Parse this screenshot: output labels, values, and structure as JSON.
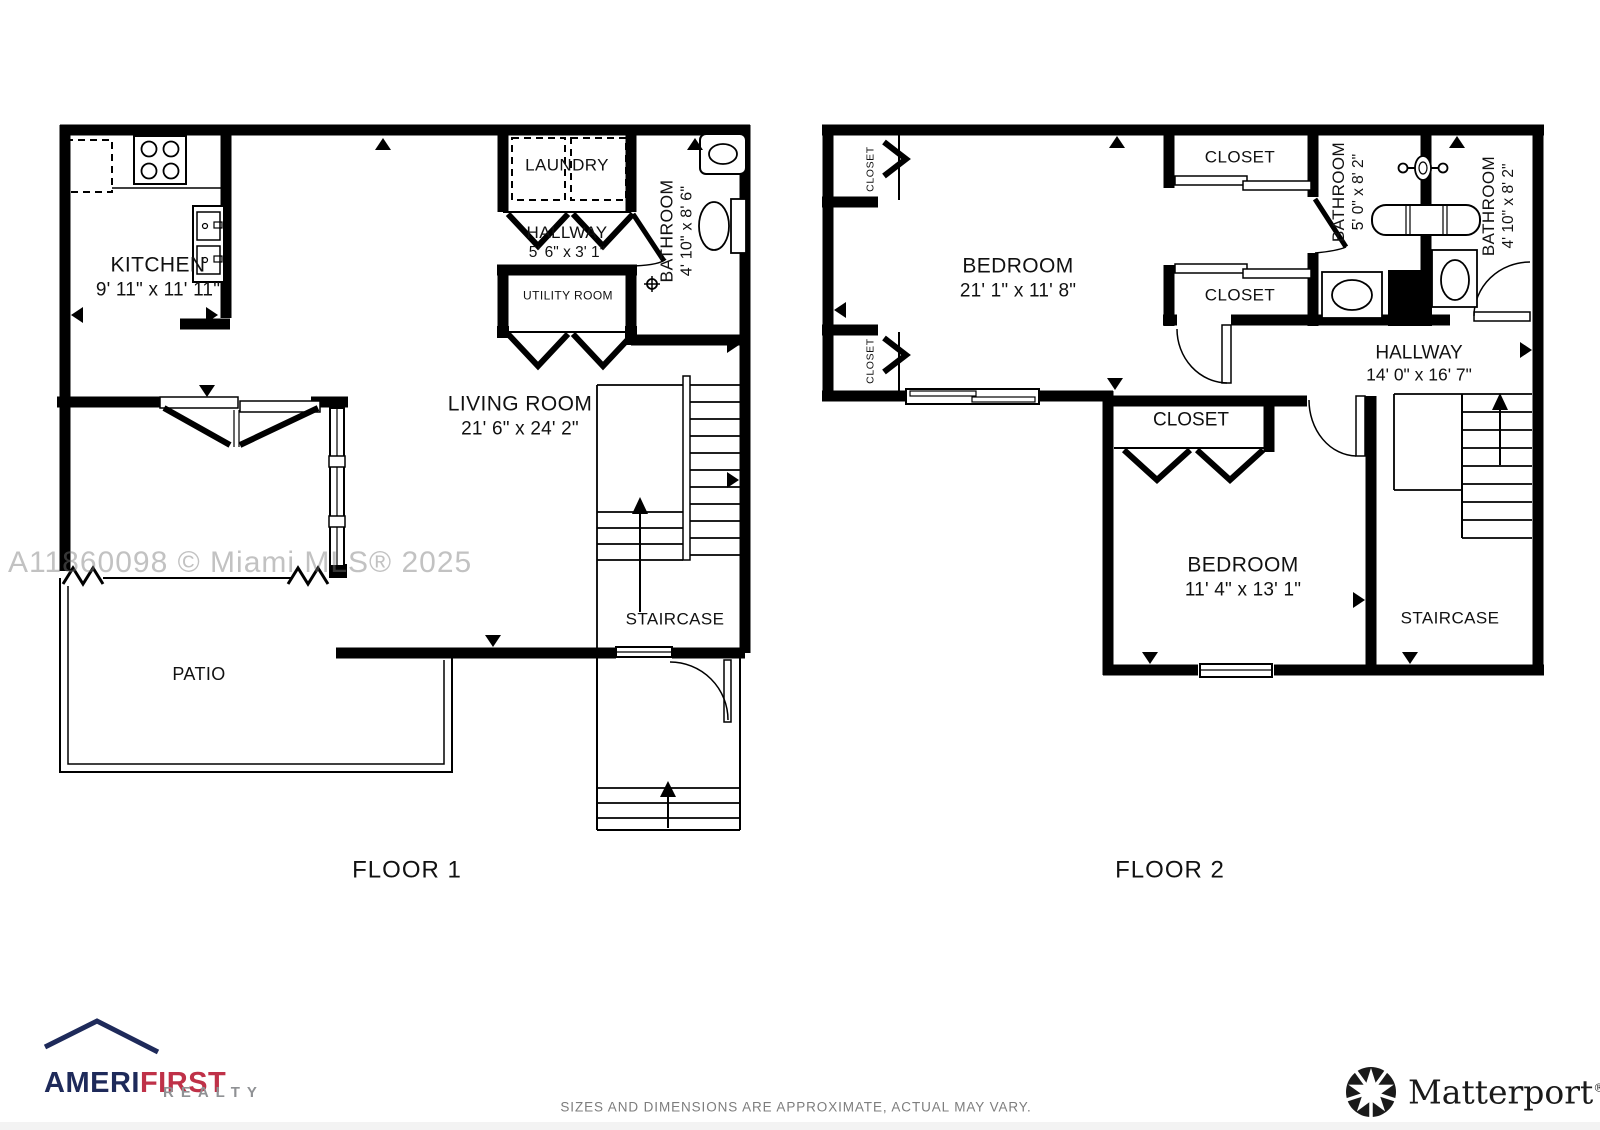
{
  "watermark": "A11860098 © Miami MLS® 2025",
  "disclaimer": "SIZES AND DIMENSIONS ARE APPROXIMATE, ACTUAL MAY VARY.",
  "floor1": {
    "title": "FLOOR 1",
    "kitchen": {
      "name": "KITCHEN",
      "dims": "9' 11\" x 11' 11\""
    },
    "laundry": {
      "name": "LAUNDRY"
    },
    "hallway": {
      "name": "HALLWAY",
      "dims": "5' 6\" x 3' 1\""
    },
    "bathroom": {
      "name": "BATHROOM",
      "dims": "4' 10\" x 8' 6\""
    },
    "utility": {
      "name": "UTILITY ROOM"
    },
    "living": {
      "name": "LIVING ROOM",
      "dims": "21' 6\" x 24' 2\""
    },
    "staircase": {
      "name": "STAIRCASE"
    },
    "patio": {
      "name": "PATIO"
    }
  },
  "floor2": {
    "title": "FLOOR 2",
    "closet_left_top": {
      "name": "CLOSET"
    },
    "closet_left_bottom": {
      "name": "CLOSET"
    },
    "bedroom1": {
      "name": "BEDROOM",
      "dims": "21' 1\" x 11' 8\""
    },
    "closet_top": {
      "name": "CLOSET"
    },
    "closet_mid": {
      "name": "CLOSET"
    },
    "bathroom1": {
      "name": "BATHROOM",
      "dims": "5' 0\" x 8' 2\""
    },
    "bathroom2": {
      "name": "BATHROOM",
      "dims": "4' 10\" x 8' 2\""
    },
    "hallway": {
      "name": "HALLWAY",
      "dims": "14' 0\" x 16' 7\""
    },
    "closet_bedroom2": {
      "name": "CLOSET"
    },
    "bedroom2": {
      "name": "BEDROOM",
      "dims": "11' 4\" x 13' 1\""
    },
    "staircase": {
      "name": "STAIRCASE"
    }
  },
  "branding": {
    "amerifirst": {
      "ameri": "AMERI",
      "first": "FIRST",
      "realty": "REALTY",
      "navy": "#1e2a5a",
      "red": "#bf3148",
      "gray": "#8f9194"
    },
    "matterport": {
      "name": "Matterport",
      "reg": "®",
      "black": "#1a1a1a"
    }
  }
}
